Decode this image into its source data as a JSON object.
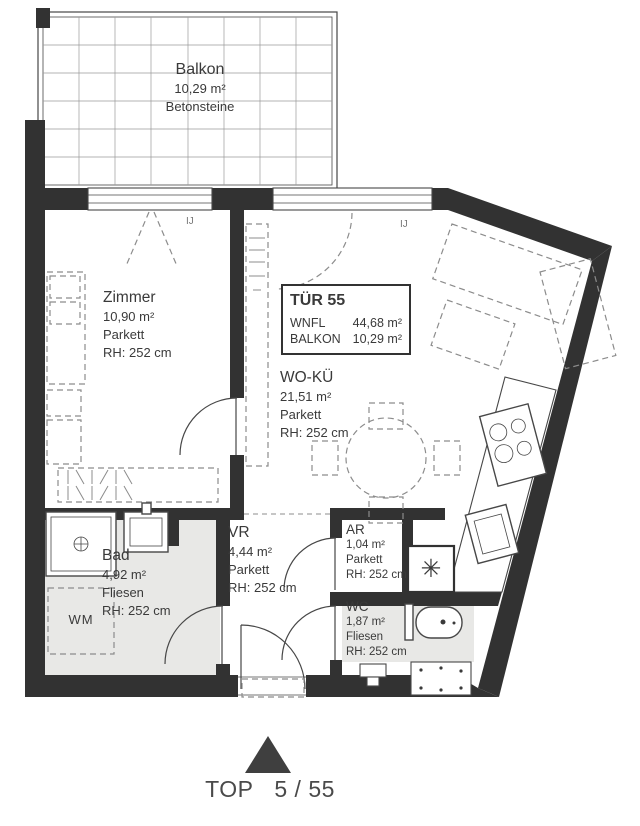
{
  "balcony": {
    "name": "Balkon",
    "area": "10,29 m²",
    "material": "Betonsteine"
  },
  "unit": {
    "door_label": "TÜR 55",
    "rows": [
      {
        "label": "WNFL",
        "value": "44,68 m²"
      },
      {
        "label": "BALKON",
        "value": "10,29 m²"
      }
    ]
  },
  "rooms": {
    "zimmer": {
      "name": "Zimmer",
      "area": "10,90 m²",
      "floor": "Parkett",
      "height": "RH: 252 cm"
    },
    "wohnkueche": {
      "name": "WO-KÜ",
      "area": "21,51 m²",
      "floor": "Parkett",
      "height": "RH: 252 cm"
    },
    "bad": {
      "name": "Bad",
      "area": "4,92 m²",
      "floor": "Fliesen",
      "height": "RH: 252 cm"
    },
    "vr": {
      "name": "VR",
      "area": "4,44 m²",
      "floor": "Parkett",
      "height": "RH: 252 cm"
    },
    "ar": {
      "name": "AR",
      "area": "1,04 m²",
      "floor": "Parkett",
      "height": "RH: 252 cm"
    },
    "wc": {
      "name": "WC",
      "area": "1,87 m²",
      "floor": "Fliesen",
      "height": "RH: 252 cm"
    }
  },
  "labels": {
    "wm": "WM",
    "window_tag_1": "IJ",
    "window_tag_2": "IJ",
    "shaft_symbol": "✳"
  },
  "footer": {
    "top_label": "TOP",
    "unit_number": "5 / 55"
  },
  "colors": {
    "wall": "#323232",
    "tile": "#e8e8e6",
    "line": "#474747",
    "dash": "#8c8c8c",
    "text": "#3a3a3a"
  }
}
